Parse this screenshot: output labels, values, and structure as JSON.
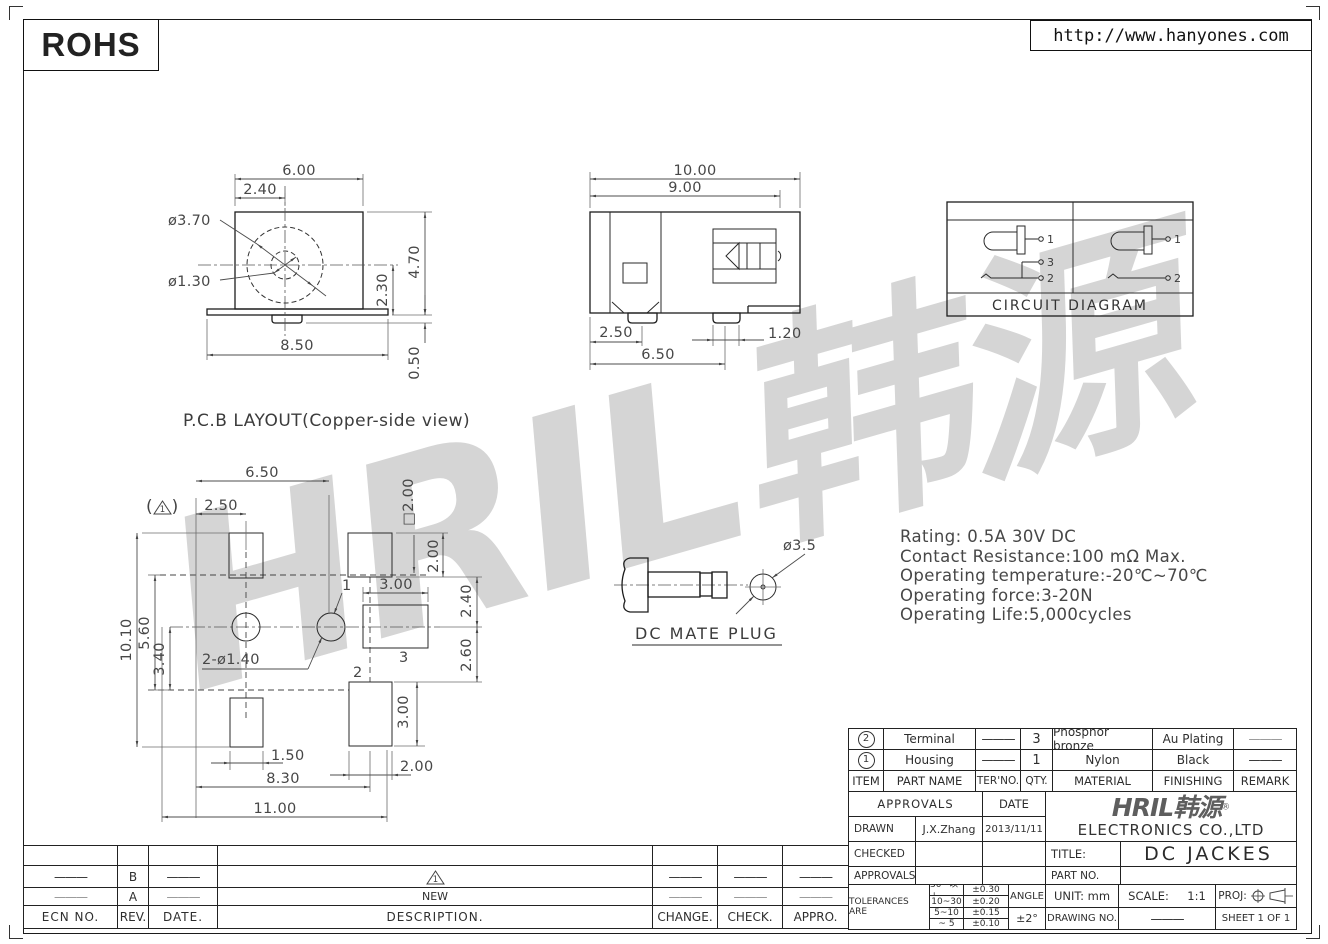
{
  "header": {
    "rohs": "ROHS",
    "url": "http://www.hanyones.com"
  },
  "watermark": "HRIL韩源",
  "front_view": {
    "d1": "6.00",
    "d2": "2.40",
    "d3": "ø3.70",
    "d4": "ø1.30",
    "d5": "4.70",
    "d6": "2.30",
    "d7": "8.50",
    "d8": "0.50"
  },
  "side_view": {
    "d1": "10.00",
    "d2": "9.00",
    "d3": "2.50",
    "d4": "6.50",
    "d5": "1.20"
  },
  "circuit": {
    "caption": "CIRCUIT  DIAGRAM",
    "left": {
      "p1": "1",
      "p3": "3",
      "p2": "2"
    },
    "right": {
      "p1": "1",
      "p2": "2"
    }
  },
  "pcb": {
    "title": "P.C.B LAYOUT(Copper-side view)",
    "rev_mark": {
      "open": "(",
      "num": "1",
      "close": ")"
    },
    "d_650": "6.50",
    "d_250": "2.50",
    "d_sq200": "□2.00",
    "d_300t": "3.00",
    "d_200r": "2.00",
    "d_240": "2.40",
    "d_260": "2.60",
    "d_300b": "3.00",
    "d_1010": "10.10",
    "d_560": "5.60",
    "d_340": "3.40",
    "d_holes": "2-ø1.40",
    "pin1": "1",
    "pin2": "2",
    "pin3": "3",
    "d_150": "1.50",
    "d_830": "8.30",
    "d_200b": "2.00",
    "d_1100": "11.00"
  },
  "plug": {
    "caption": "DC  MATE  PLUG",
    "dia": "ø3.5"
  },
  "specs": {
    "l1": "Rating: 0.5A 30V DC",
    "l2": "Contact Resistance:100 mΩ Max.",
    "l3": "Operating temperature:-20℃~70℃",
    "l4": "Operating force:3-20N",
    "l5": "Operating Life:5,000cycles"
  },
  "title_block": {
    "parts": {
      "headers": {
        "item": "ITEM",
        "part_name": "PART NAME",
        "ter_no": "TER'NO.",
        "qty": "QTY.",
        "material": "MATERIAL",
        "finishing": "FINISHING",
        "remark": "REMARK"
      },
      "rows": [
        {
          "item": "2",
          "part_name": "Terminal",
          "ter_no": "———",
          "qty": "3",
          "material": "Phosphor bronze",
          "finishing": "Au Plating",
          "remark": "———"
        },
        {
          "item": "1",
          "part_name": "Housing",
          "ter_no": "———",
          "qty": "1",
          "material": "Nylon",
          "finishing": "Black",
          "remark": "———"
        }
      ]
    },
    "approvals": {
      "header": "APPROVALS",
      "date_header": "DATE",
      "rows": [
        {
          "label": "DRAWN",
          "name": "J.X.Zhang",
          "date": "2013/11/11"
        },
        {
          "label": "CHECKED",
          "name": "",
          "date": ""
        },
        {
          "label": "APPROVALS",
          "name": "",
          "date": ""
        }
      ]
    },
    "company": {
      "logo": "HRIL韩源",
      "reg": "®",
      "name": "ELECTRONICS  CO.,LTD"
    },
    "title_label": "TITLE:",
    "title_value": "DC  JACKES",
    "part_no_label": "PART NO.",
    "tol": {
      "label": "TOLERANCES ARE",
      "rows": [
        {
          "range": "30~以上",
          "val": "±0.30"
        },
        {
          "range": "10~30",
          "val": "±0.20"
        },
        {
          "range": "5~10",
          "val": "±0.15"
        },
        {
          "range": "~ 5",
          "val": "±0.10"
        }
      ],
      "angle_label": "ANGLE",
      "angle_val": "±2°"
    },
    "unit": "UNIT: mm",
    "scale_label": "SCALE:",
    "scale_val": "1:1",
    "proj_label": "PROJ:",
    "drawing_no": "DRAWING NO.",
    "dash": "———",
    "sheet": "SHEET  1 OF 1"
  },
  "rev_table": {
    "headers": {
      "ecn": "ECN NO.",
      "rev": "REV.",
      "date": "DATE.",
      "desc": "DESCRIPTION.",
      "change": "CHANGE.",
      "check": "CHECK.",
      "appro": "APPRO."
    },
    "row_b": {
      "ecn": "———",
      "rev": "B",
      "date": "———",
      "tri": "1",
      "change": "———",
      "check": "———",
      "appro": "———"
    },
    "row_a": {
      "ecn": "———",
      "rev": "A",
      "date": "———",
      "desc": "NEW",
      "change": "———",
      "check": "———",
      "appro": "———"
    }
  }
}
